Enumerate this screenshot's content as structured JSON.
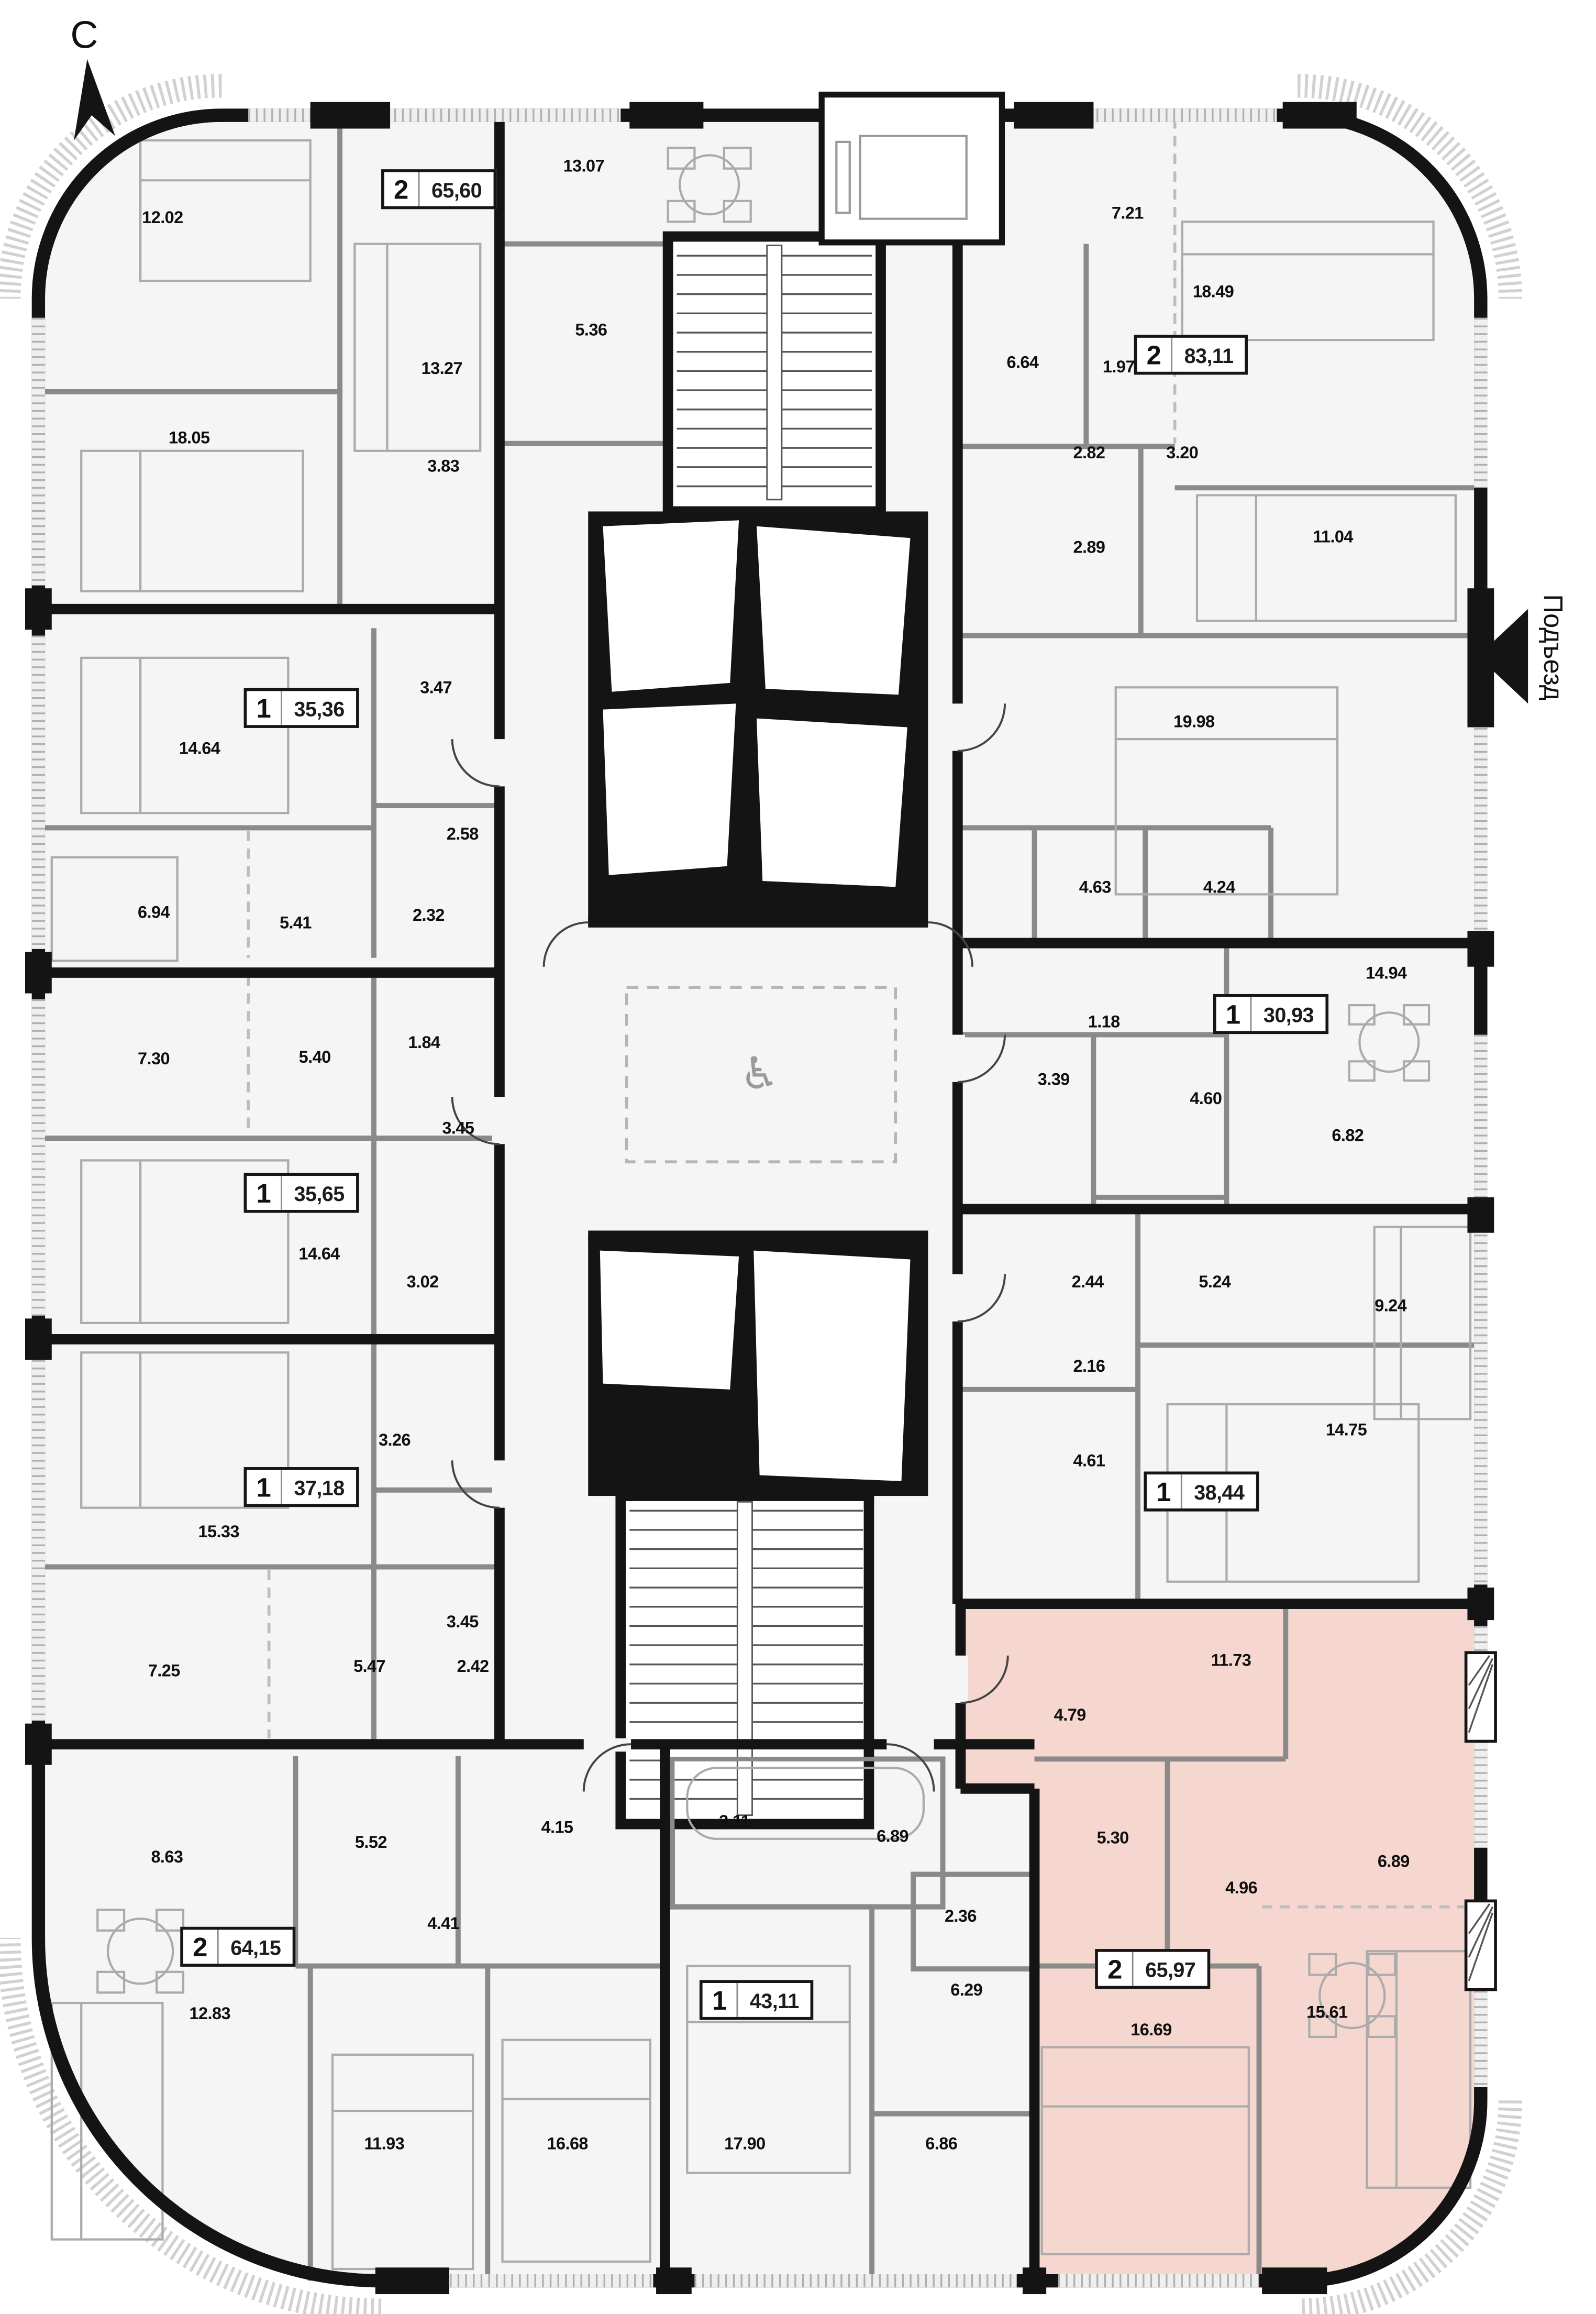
{
  "compass": {
    "letter": "С"
  },
  "entrance": {
    "label": "Подъезд"
  },
  "core": {
    "wheelchair_icon": "♿"
  },
  "colors": {
    "highlight": "#F6D7CF",
    "walls": "#141414",
    "partitions": "#8A8A8A"
  },
  "apartments": [
    {
      "rooms": "2",
      "area": "65,60",
      "highlighted": false
    },
    {
      "rooms": "2",
      "area": "83,11",
      "highlighted": false
    },
    {
      "rooms": "1",
      "area": "35,36",
      "highlighted": false
    },
    {
      "rooms": "1",
      "area": "30,93",
      "highlighted": false
    },
    {
      "rooms": "1",
      "area": "35,65",
      "highlighted": false
    },
    {
      "rooms": "1",
      "area": "38,44",
      "highlighted": false
    },
    {
      "rooms": "1",
      "area": "37,18",
      "highlighted": false
    },
    {
      "rooms": "2",
      "area": "64,15",
      "highlighted": false
    },
    {
      "rooms": "1",
      "area": "43,11",
      "highlighted": false
    },
    {
      "rooms": "2",
      "area": "65,97",
      "highlighted": true
    }
  ],
  "room_labels": [
    {
      "value": "12.02"
    },
    {
      "value": "13.07"
    },
    {
      "value": "13.27"
    },
    {
      "value": "5.36"
    },
    {
      "value": "18.05"
    },
    {
      "value": "3.83"
    },
    {
      "value": "7.21"
    },
    {
      "value": "18.49"
    },
    {
      "value": "6.64"
    },
    {
      "value": "1.97"
    },
    {
      "value": "2.82"
    },
    {
      "value": "3.20"
    },
    {
      "value": "2.89"
    },
    {
      "value": "11.04"
    },
    {
      "value": "14.64"
    },
    {
      "value": "3.47"
    },
    {
      "value": "2.58"
    },
    {
      "value": "19.98"
    },
    {
      "value": "6.94"
    },
    {
      "value": "5.41"
    },
    {
      "value": "2.32"
    },
    {
      "value": "4.63"
    },
    {
      "value": "4.24"
    },
    {
      "value": "14.94"
    },
    {
      "value": "7.30"
    },
    {
      "value": "5.40"
    },
    {
      "value": "1.84"
    },
    {
      "value": "1.18"
    },
    {
      "value": "3.39"
    },
    {
      "value": "4.60"
    },
    {
      "value": "3.45"
    },
    {
      "value": "6.82"
    },
    {
      "value": "14.64"
    },
    {
      "value": "3.02"
    },
    {
      "value": "2.44"
    },
    {
      "value": "5.24"
    },
    {
      "value": "9.24"
    },
    {
      "value": "2.16"
    },
    {
      "value": "3.26"
    },
    {
      "value": "15.33"
    },
    {
      "value": "4.61"
    },
    {
      "value": "14.75"
    },
    {
      "value": "3.45"
    },
    {
      "value": "7.25"
    },
    {
      "value": "5.47"
    },
    {
      "value": "2.42"
    },
    {
      "value": "11.73"
    },
    {
      "value": "4.79"
    },
    {
      "value": "8.63"
    },
    {
      "value": "5.52"
    },
    {
      "value": "4.15"
    },
    {
      "value": "3.11"
    },
    {
      "value": "6.89"
    },
    {
      "value": "5.30"
    },
    {
      "value": "6.89"
    },
    {
      "value": "4.96"
    },
    {
      "value": "2.36"
    },
    {
      "value": "4.41"
    },
    {
      "value": "6.29"
    },
    {
      "value": "12.83"
    },
    {
      "value": "16.69"
    },
    {
      "value": "15.61"
    },
    {
      "value": "11.93"
    },
    {
      "value": "16.68"
    },
    {
      "value": "17.90"
    },
    {
      "value": "6.86"
    }
  ]
}
